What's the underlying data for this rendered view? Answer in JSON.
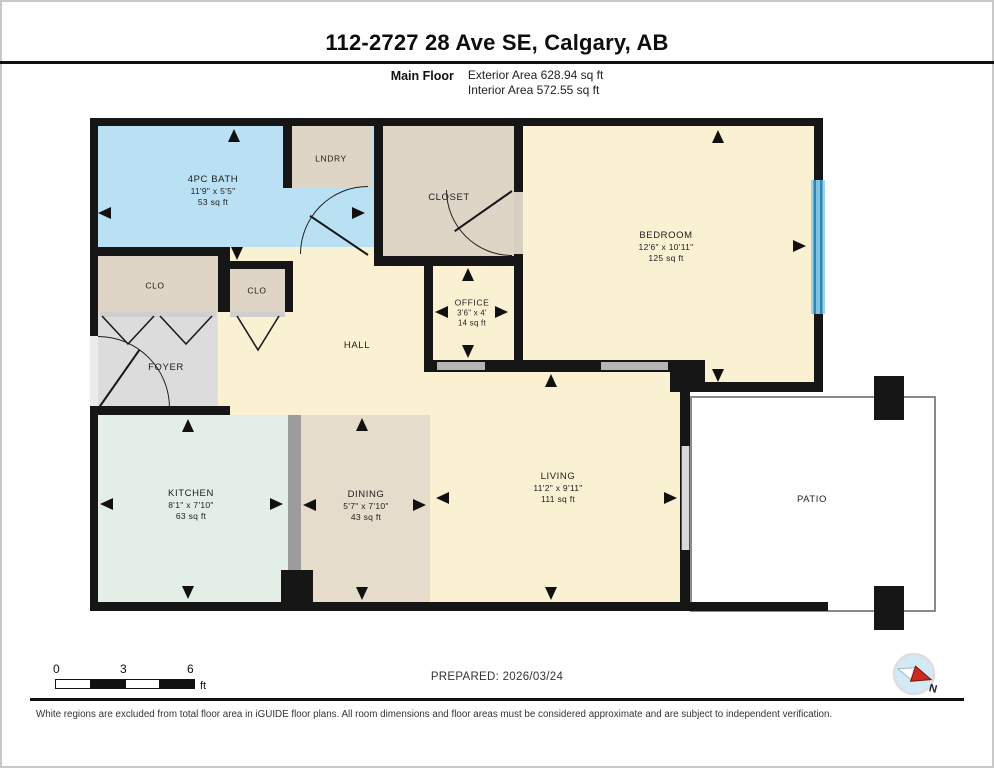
{
  "header": {
    "title": "112-2727 28 Ave SE, Calgary, AB",
    "floor_label": "Main Floor",
    "exterior_area": "Exterior Area 628.94 sq ft",
    "interior_area": "Interior Area 572.55 sq ft"
  },
  "rooms": {
    "bath": {
      "name": "4PC BATH",
      "dims": "11'9\" x 5'5\"",
      "area": "53 sq ft"
    },
    "lndry": {
      "name": "LNDRY"
    },
    "closet": {
      "name": "CLOSET"
    },
    "bedroom": {
      "name": "BEDROOM",
      "dims": "12'6\" x 10'11\"",
      "area": "125 sq ft"
    },
    "clo1": {
      "name": "CLO"
    },
    "clo2": {
      "name": "CLO"
    },
    "office": {
      "name": "OFFICE",
      "dims": "3'6\" x 4'",
      "area": "14 sq ft"
    },
    "hall": {
      "name": "HALL"
    },
    "foyer": {
      "name": "FOYER"
    },
    "kitchen": {
      "name": "KITCHEN",
      "dims": "8'1\" x 7'10\"",
      "area": "63 sq ft"
    },
    "dining": {
      "name": "DINING",
      "dims": "5'7\" x 7'10\"",
      "area": "43 sq ft"
    },
    "living": {
      "name": "LIVING",
      "dims": "11'2\" x 9'11\"",
      "area": "111 sq ft"
    },
    "patio": {
      "name": "PATIO"
    }
  },
  "footer": {
    "scale": {
      "tick0": "0",
      "tick1": "3",
      "tick2": "6",
      "unit": "ft"
    },
    "prepared": "PREPARED: 2026/03/24",
    "compass_label": "N",
    "disclaimer": "White regions are excluded from total floor area in iGUIDE floor plans. All room dimensions and floor areas must be considered approximate and are subject to independent verification."
  },
  "colors": {
    "wall": "#161616",
    "bath_blue": "#b9e0f3",
    "beige": "#ded5c6",
    "cream": "#faf0d2",
    "foyer_gray": "#dcdcdc",
    "kitchen_mint": "#e3eee7",
    "dining_tan": "#e6dccb",
    "window_blue": "#2f85ad",
    "compass_red": "#cc2a20"
  }
}
